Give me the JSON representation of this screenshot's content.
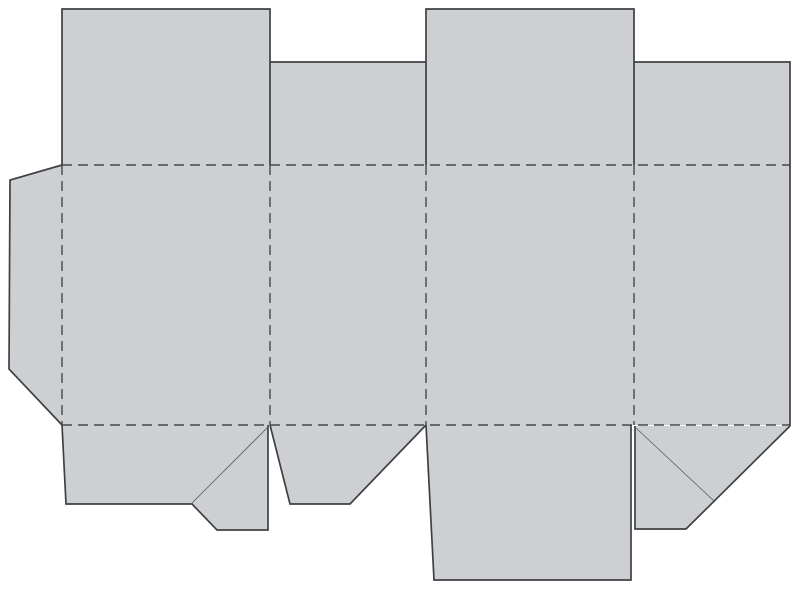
{
  "canvas": {
    "width": 800,
    "height": 606,
    "background": "#ffffff"
  },
  "colors": {
    "panel_fill": "#cdcfd2",
    "cut_line": "#3e4144",
    "fold_line": "#47494c",
    "crease_line": "#575a5d"
  },
  "line_style": {
    "cut_width": 1.7,
    "fold_width": 1.4,
    "crease_width": 0.8,
    "fold_dash": "10 6"
  },
  "dieline": {
    "panels": [
      {
        "name": "glue-flap-panel",
        "points": [
          [
            62,
            165
          ],
          [
            10,
            180
          ],
          [
            9,
            369
          ],
          [
            62,
            425
          ]
        ]
      },
      {
        "name": "body-panels",
        "points": [
          [
            62,
            165
          ],
          [
            790,
            165
          ],
          [
            790,
            425
          ],
          [
            62,
            425
          ]
        ]
      },
      {
        "name": "top-flap-1-panel",
        "points": [
          [
            62,
            9
          ],
          [
            270,
            9
          ],
          [
            270,
            165
          ],
          [
            62,
            165
          ]
        ]
      },
      {
        "name": "top-flap-2-panel",
        "points": [
          [
            270,
            62
          ],
          [
            426,
            62
          ],
          [
            426,
            165
          ],
          [
            270,
            165
          ]
        ]
      },
      {
        "name": "top-flap-3-panel",
        "points": [
          [
            426,
            9
          ],
          [
            634,
            9
          ],
          [
            634,
            165
          ],
          [
            426,
            165
          ]
        ]
      },
      {
        "name": "top-flap-4-panel",
        "points": [
          [
            634,
            62
          ],
          [
            790,
            62
          ],
          [
            790,
            165
          ],
          [
            634,
            165
          ]
        ]
      },
      {
        "name": "bottom-flap-1-panel",
        "points": [
          [
            62,
            425
          ],
          [
            268,
            425
          ],
          [
            268,
            530
          ],
          [
            217,
            530
          ],
          [
            192,
            504
          ],
          [
            66,
            504
          ]
        ]
      },
      {
        "name": "bottom-flap-2-panel",
        "points": [
          [
            270,
            425
          ],
          [
            426,
            425
          ],
          [
            350,
            504
          ],
          [
            290,
            504
          ]
        ]
      },
      {
        "name": "bottom-flap-3-panel",
        "points": [
          [
            426,
            425
          ],
          [
            631,
            425
          ],
          [
            631,
            580
          ],
          [
            434,
            580
          ]
        ]
      },
      {
        "name": "bottom-flap-4-panel",
        "points": [
          [
            635,
            426
          ],
          [
            790,
            426
          ],
          [
            686,
            529
          ],
          [
            635,
            529
          ]
        ]
      }
    ],
    "cut_lines": [
      {
        "name": "glue-flap-cut",
        "points": [
          [
            62,
            165
          ],
          [
            10,
            180
          ],
          [
            9,
            369
          ],
          [
            62,
            425
          ]
        ]
      },
      {
        "name": "top-flap-1-cut",
        "points": [
          [
            62,
            165
          ],
          [
            62,
            9
          ],
          [
            270,
            9
          ],
          [
            270,
            165
          ]
        ]
      },
      {
        "name": "top-flap-2-cut",
        "points": [
          [
            270,
            62
          ],
          [
            426,
            62
          ]
        ]
      },
      {
        "name": "top-flap-3-cut",
        "points": [
          [
            426,
            165
          ],
          [
            426,
            9
          ],
          [
            634,
            9
          ],
          [
            634,
            165
          ]
        ]
      },
      {
        "name": "top-flap-4-cut",
        "points": [
          [
            634,
            62
          ],
          [
            790,
            62
          ],
          [
            790,
            426
          ]
        ]
      },
      {
        "name": "bottom-flap-1-cut",
        "points": [
          [
            62,
            425
          ],
          [
            66,
            504
          ],
          [
            192,
            504
          ],
          [
            217,
            530
          ],
          [
            268,
            530
          ],
          [
            268,
            425
          ]
        ]
      },
      {
        "name": "bottom-flap-2-cut",
        "points": [
          [
            270,
            425
          ],
          [
            290,
            504
          ],
          [
            350,
            504
          ],
          [
            426,
            425
          ]
        ]
      },
      {
        "name": "bottom-flap-3-cut",
        "points": [
          [
            426,
            425
          ],
          [
            434,
            580
          ],
          [
            631,
            580
          ],
          [
            631,
            425
          ]
        ]
      },
      {
        "name": "bottom-flap-4-cut",
        "points": [
          [
            635,
            426
          ],
          [
            635,
            529
          ],
          [
            686,
            529
          ],
          [
            790,
            426
          ]
        ]
      }
    ],
    "crease_lines": [
      {
        "name": "bottom-flap-1-crease",
        "points": [
          [
            192,
            503
          ],
          [
            268,
            427
          ]
        ]
      },
      {
        "name": "bottom-flap-4-crease",
        "points": [
          [
            636,
            428
          ],
          [
            714,
            501
          ]
        ]
      }
    ],
    "fold_lines": [
      {
        "name": "top-horizontal-fold",
        "points": [
          [
            62,
            165
          ],
          [
            790,
            165
          ]
        ]
      },
      {
        "name": "bottom-horizontal-fold",
        "points": [
          [
            62,
            425
          ],
          [
            790,
            425
          ]
        ]
      },
      {
        "name": "vertical-fold-1",
        "points": [
          [
            62,
            165
          ],
          [
            62,
            425
          ]
        ]
      },
      {
        "name": "vertical-fold-2",
        "points": [
          [
            270,
            165
          ],
          [
            270,
            425
          ]
        ]
      },
      {
        "name": "vertical-fold-3",
        "points": [
          [
            426,
            165
          ],
          [
            426,
            425
          ]
        ]
      },
      {
        "name": "vertical-fold-4",
        "points": [
          [
            634,
            165
          ],
          [
            634,
            425
          ]
        ]
      }
    ]
  }
}
